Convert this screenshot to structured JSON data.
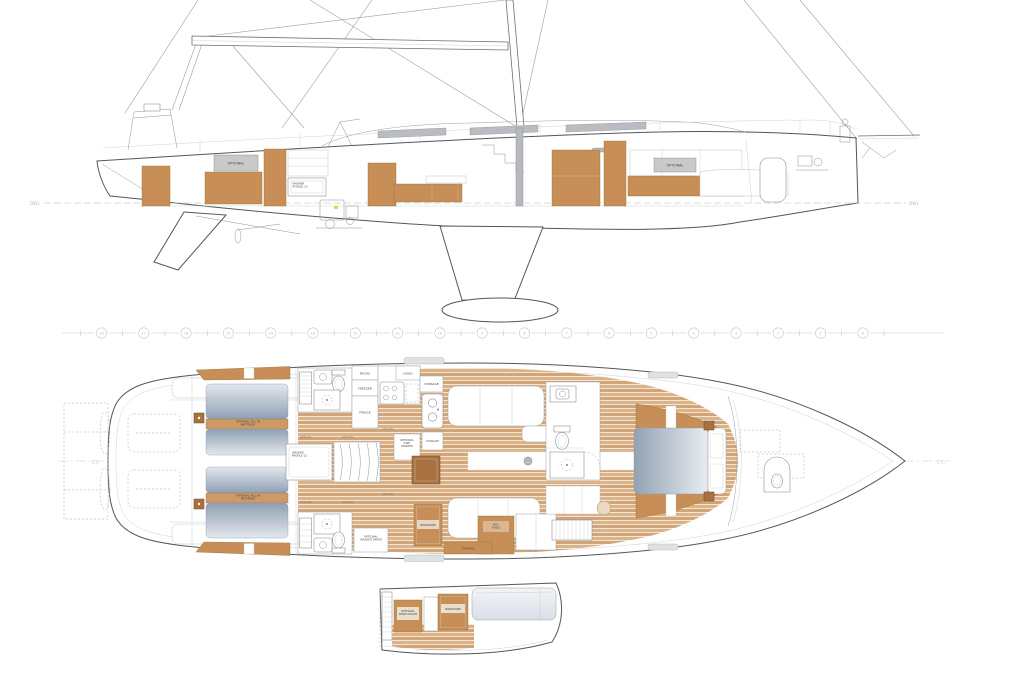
{
  "colors": {
    "wood": "#c78f57",
    "wood_dark": "#a8713f",
    "teak_floor": "#d9b18a",
    "teak_seam": "#ffffff",
    "mattress_dark": "#8fa0b3",
    "mattress_light": "#e3e8ee",
    "window_gray": "#b9bdc1",
    "label_gray": "#c9c9c9",
    "outline": "#55565a"
  },
  "profile": {
    "waterline_left": "DWL",
    "waterline_right": "DWL",
    "optional_aft": "OPTIONAL",
    "optional_fwd": "OPTIONAL",
    "engine_box": "WASHER\nPADDLE 12"
  },
  "stations": {
    "numbers": [
      "18",
      "17",
      "16",
      "15",
      "14",
      "13",
      "12",
      "11",
      "10",
      "9",
      "8",
      "7",
      "6",
      "5",
      "4",
      "3",
      "2",
      "1",
      "0"
    ]
  },
  "plan": {
    "centerline_left": "C.L.",
    "centerline_right": "C.L.",
    "keel_box": "WASHER\nPADDLE 12",
    "aft_cabins": {
      "port_mattress": "OPTIONAL FILL IN\nMATTRESS",
      "stbd_mattress": "OPTIONAL FILL IN\nMATTRESS"
    },
    "galley": {
      "micro": "MICRO",
      "freezer": "FREEZER",
      "fridge": "FRIDGE",
      "hood": "HOOD",
      "storage_upper": "STORAGE",
      "dish_washer": "OPTIONAL\nDISH\nWASHER",
      "storage_lower": "STORAGE"
    },
    "heads": {
      "washer_dryer": "OPTIONAL\nWASHER DRYER"
    },
    "saloon": {
      "wardrobe": "WARDROBE",
      "nav_table": "NAV.\nTABLE",
      "storage_drawer": "STORAGE"
    },
    "tanks": {
      "p1": "-200 GAL.",
      "p2": "-200 GAL.",
      "p3": "-150 GAL.",
      "s1": "-200 GAL.",
      "s2": "-200 GAL.",
      "s3": "-150 GAL."
    }
  },
  "partial": {
    "wine_cooler": "OPTIONAL\nWINECOOLER",
    "wardrobe": "WARDROBE"
  }
}
